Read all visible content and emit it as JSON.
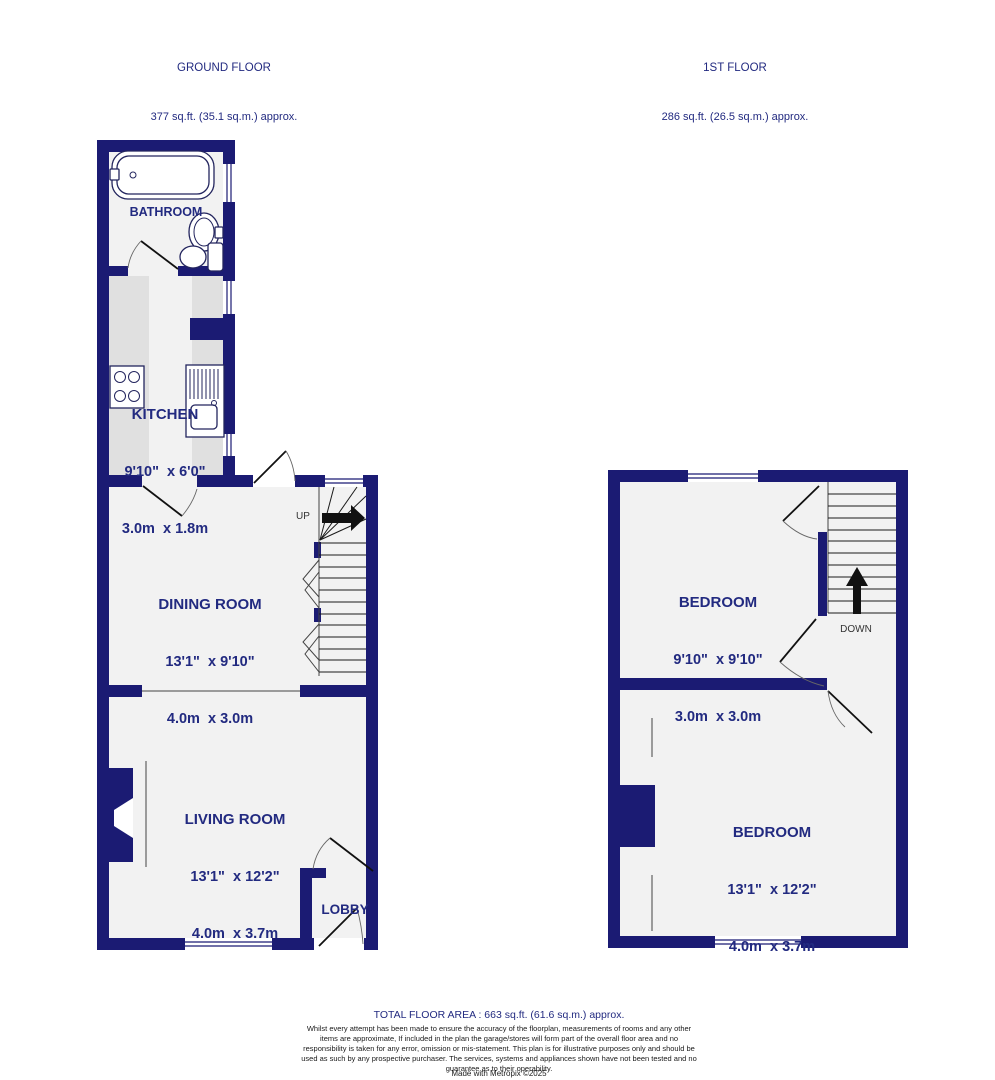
{
  "header": {
    "ground": {
      "title": "GROUND FLOOR",
      "area": "377 sq.ft. (35.1 sq.m.) approx."
    },
    "first": {
      "title": "1ST FLOOR",
      "area": "286 sq.ft. (26.5 sq.m.) approx."
    }
  },
  "rooms": {
    "bathroom": {
      "name": "BATHROOM"
    },
    "kitchen": {
      "name": "KITCHEN",
      "imperial": "9'10\"  x 6'0\"",
      "metric": "3.0m  x 1.8m"
    },
    "dining_room": {
      "name": "DINING ROOM",
      "imperial": "13'1\"  x 9'10\"",
      "metric": "4.0m  x 3.0m"
    },
    "living_room": {
      "name": "LIVING ROOM",
      "imperial": "13'1\"  x 12'2\"",
      "metric": "4.0m  x 3.7m"
    },
    "lobby": {
      "name": "LOBBY"
    },
    "bedroom_one": {
      "name": "BEDROOM",
      "imperial": "9'10\"  x 9'10\"",
      "metric": "3.0m  x 3.0m"
    },
    "bedroom_two": {
      "name": "BEDROOM",
      "imperial": "13'1\"  x 12'2\"",
      "metric": "4.0m  x 3.7m"
    }
  },
  "stairs": {
    "up": "UP",
    "down": "DOWN"
  },
  "footer": {
    "total": "TOTAL FLOOR AREA : 663 sq.ft. (61.6 sq.m.) approx.",
    "disclaimer": "Whilst every attempt has been made to ensure the accuracy of the floorplan, measurements of rooms and any other items are approximate, If included in the plan the garage/stores will form part of the overall floor area and no responsibility is taken for any error, omission or mis-statement. This plan is for illustrative purposes only and should be used as such by any prospective purchaser. The services, systems and appliances shown have not been tested and no guarantee as to their operability.",
    "credit": "Made with Metropix ©2025"
  },
  "colors": {
    "wall": "#1b1b73",
    "accent_text": "#222a80",
    "floor": "#f2f2f2",
    "counter": "#e0e0e0"
  }
}
